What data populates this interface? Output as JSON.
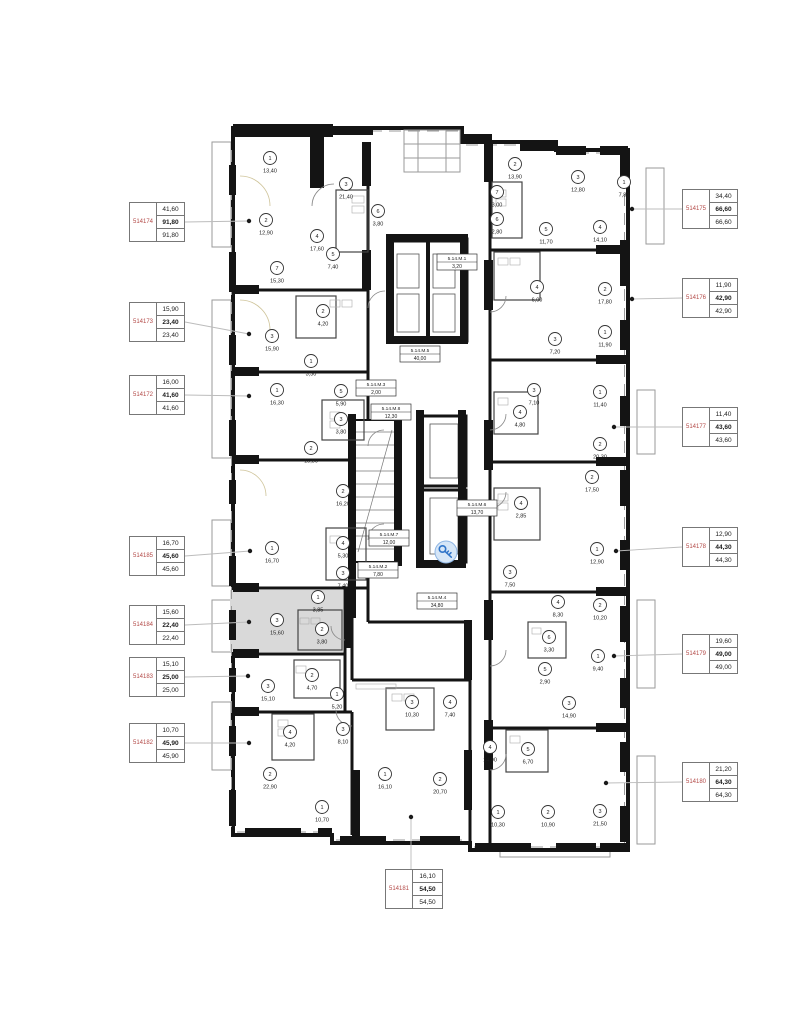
{
  "colors": {
    "wall": "#141414",
    "label_red": "#b34a48",
    "highlight_gray": "#d9d9d9",
    "marker_blue": "#2f74c9",
    "marker_fill": "#d6e6f7",
    "leader_gray": "#bcbcbc"
  },
  "apartment_labels": [
    {
      "id": "514174",
      "values": [
        "41,60",
        "91,80",
        "91,80"
      ],
      "side": "left",
      "box": {
        "x": 129,
        "y": 202,
        "w": 56,
        "h": 40
      },
      "dot": {
        "x": 249,
        "y": 221
      }
    },
    {
      "id": "514173",
      "values": [
        "15,90",
        "23,40",
        "23,40"
      ],
      "side": "left",
      "box": {
        "x": 129,
        "y": 302,
        "w": 56,
        "h": 40
      },
      "dot": {
        "x": 249,
        "y": 334
      }
    },
    {
      "id": "514172",
      "values": [
        "16,00",
        "41,60",
        "41,60"
      ],
      "side": "left",
      "box": {
        "x": 129,
        "y": 375,
        "w": 56,
        "h": 40
      },
      "dot": {
        "x": 249,
        "y": 396
      }
    },
    {
      "id": "514185",
      "values": [
        "16,70",
        "45,60",
        "45,60"
      ],
      "side": "left",
      "box": {
        "x": 129,
        "y": 536,
        "w": 56,
        "h": 40
      },
      "dot": {
        "x": 250,
        "y": 551
      }
    },
    {
      "id": "514184",
      "values": [
        "15,60",
        "22,40",
        "22,40"
      ],
      "side": "left",
      "box": {
        "x": 129,
        "y": 605,
        "w": 56,
        "h": 40
      },
      "dot": {
        "x": 249,
        "y": 622
      }
    },
    {
      "id": "514183",
      "values": [
        "15,10",
        "25,00",
        "25,00"
      ],
      "side": "left",
      "box": {
        "x": 129,
        "y": 657,
        "w": 56,
        "h": 40
      },
      "dot": {
        "x": 248,
        "y": 676
      }
    },
    {
      "id": "514182",
      "values": [
        "10,70",
        "45,90",
        "45,90"
      ],
      "side": "left",
      "box": {
        "x": 129,
        "y": 723,
        "w": 56,
        "h": 40
      },
      "dot": {
        "x": 249,
        "y": 743
      }
    },
    {
      "id": "514175",
      "values": [
        "34,40",
        "66,60",
        "66,60"
      ],
      "side": "right",
      "box": {
        "x": 682,
        "y": 189,
        "w": 56,
        "h": 40
      },
      "dot": {
        "x": 632,
        "y": 209
      }
    },
    {
      "id": "514176",
      "values": [
        "11,90",
        "42,90",
        "42,90"
      ],
      "side": "right",
      "box": {
        "x": 682,
        "y": 278,
        "w": 56,
        "h": 40
      },
      "dot": {
        "x": 632,
        "y": 299
      }
    },
    {
      "id": "514177",
      "values": [
        "11,40",
        "43,60",
        "43,60"
      ],
      "side": "right",
      "box": {
        "x": 682,
        "y": 407,
        "w": 56,
        "h": 40
      },
      "dot": {
        "x": 614,
        "y": 427
      }
    },
    {
      "id": "514178",
      "values": [
        "12,90",
        "44,30",
        "44,30"
      ],
      "side": "right",
      "box": {
        "x": 682,
        "y": 527,
        "w": 56,
        "h": 40
      },
      "dot": {
        "x": 616,
        "y": 551
      }
    },
    {
      "id": "514179",
      "values": [
        "19,60",
        "49,00",
        "49,00"
      ],
      "side": "right",
      "box": {
        "x": 682,
        "y": 634,
        "w": 56,
        "h": 40
      },
      "dot": {
        "x": 614,
        "y": 656
      }
    },
    {
      "id": "514180",
      "values": [
        "21,20",
        "64,30",
        "64,30"
      ],
      "side": "right",
      "box": {
        "x": 682,
        "y": 762,
        "w": 56,
        "h": 40
      },
      "dot": {
        "x": 606,
        "y": 783
      }
    },
    {
      "id": "514181",
      "values": [
        "16,10",
        "54,50",
        "54,50"
      ],
      "side": "bottom",
      "box": {
        "x": 385,
        "y": 869,
        "w": 58,
        "h": 40
      },
      "dot": {
        "x": 411,
        "y": 817
      }
    }
  ],
  "plan": {
    "selected_apartment": "514184",
    "marker": {
      "x": 446,
      "y": 552,
      "icon": "key"
    },
    "rooms": [
      {
        "apt": "514174",
        "num": "1",
        "area": "13,40",
        "x": 270,
        "y": 158
      },
      {
        "apt": "514174",
        "num": "3",
        "area": "21,40",
        "x": 346,
        "y": 184
      },
      {
        "apt": "514174",
        "num": "2",
        "area": "12,90",
        "x": 266,
        "y": 220
      },
      {
        "apt": "514174",
        "num": "4",
        "area": "17,60",
        "x": 317,
        "y": 236
      },
      {
        "apt": "514174",
        "num": "5",
        "area": "7,40",
        "x": 333,
        "y": 254
      },
      {
        "apt": "514174",
        "num": "6",
        "area": "3,80",
        "x": 378,
        "y": 211
      },
      {
        "apt": "514174",
        "num": "7",
        "area": "15,30",
        "x": 277,
        "y": 268
      },
      {
        "apt": "514173",
        "num": "2",
        "area": "4,20",
        "x": 323,
        "y": 311
      },
      {
        "apt": "514173",
        "num": "3",
        "area": "15,90",
        "x": 272,
        "y": 336
      },
      {
        "apt": "514173",
        "num": "1",
        "area": "3,30",
        "x": 311,
        "y": 361
      },
      {
        "apt": "514172",
        "num": "1",
        "area": "16,30",
        "x": 277,
        "y": 390
      },
      {
        "apt": "514172",
        "num": "5",
        "area": "5,90",
        "x": 341,
        "y": 391
      },
      {
        "apt": "514172",
        "num": "3",
        "area": "3,80",
        "x": 341,
        "y": 419
      },
      {
        "apt": "514172",
        "num": "2",
        "area": "15,80",
        "x": 311,
        "y": 448
      },
      {
        "apt": "514185",
        "num": "2",
        "area": "16,20",
        "x": 343,
        "y": 491
      },
      {
        "apt": "514185",
        "num": "4",
        "area": "5,30",
        "x": 343,
        "y": 543
      },
      {
        "apt": "514185",
        "num": "3",
        "area": "7,40",
        "x": 343,
        "y": 573
      },
      {
        "apt": "514185",
        "num": "1",
        "area": "16,70",
        "x": 272,
        "y": 548
      },
      {
        "apt": "514184",
        "num": "1",
        "area": "3,85",
        "x": 318,
        "y": 597
      },
      {
        "apt": "514184",
        "num": "3",
        "area": "15,60",
        "x": 277,
        "y": 620
      },
      {
        "apt": "514184",
        "num": "2",
        "area": "3,80",
        "x": 322,
        "y": 629
      },
      {
        "apt": "514183",
        "num": "2",
        "area": "4,70",
        "x": 312,
        "y": 675
      },
      {
        "apt": "514183",
        "num": "3",
        "area": "15,10",
        "x": 268,
        "y": 686
      },
      {
        "apt": "514183",
        "num": "1",
        "area": "5,20",
        "x": 337,
        "y": 694
      },
      {
        "apt": "514182",
        "num": "4",
        "area": "4,20",
        "x": 290,
        "y": 732
      },
      {
        "apt": "514182",
        "num": "3",
        "area": "8,10",
        "x": 343,
        "y": 729
      },
      {
        "apt": "514182",
        "num": "2",
        "area": "22,90",
        "x": 270,
        "y": 774
      },
      {
        "apt": "514182",
        "num": "1",
        "area": "10,70",
        "x": 322,
        "y": 807
      },
      {
        "apt": "514181",
        "num": "3",
        "area": "10,30",
        "x": 412,
        "y": 702
      },
      {
        "apt": "514181",
        "num": "4",
        "area": "7,40",
        "x": 450,
        "y": 702
      },
      {
        "apt": "514181",
        "num": "1",
        "area": "16,10",
        "x": 385,
        "y": 774
      },
      {
        "apt": "514181",
        "num": "2",
        "area": "20,70",
        "x": 440,
        "y": 779
      },
      {
        "apt": "514175",
        "num": "2",
        "area": "13,90",
        "x": 515,
        "y": 164
      },
      {
        "apt": "514175",
        "num": "3",
        "area": "12,80",
        "x": 578,
        "y": 177
      },
      {
        "apt": "514175",
        "num": "1",
        "area": "7,80",
        "x": 624,
        "y": 182
      },
      {
        "apt": "514175",
        "num": "7",
        "area": "3,00",
        "x": 497,
        "y": 192
      },
      {
        "apt": "514175",
        "num": "6",
        "area": "2,80",
        "x": 497,
        "y": 219
      },
      {
        "apt": "514175",
        "num": "5",
        "area": "11,70",
        "x": 546,
        "y": 229
      },
      {
        "apt": "514175",
        "num": "4",
        "area": "14,10",
        "x": 600,
        "y": 227
      },
      {
        "apt": "514176",
        "num": "4",
        "area": "6,00",
        "x": 537,
        "y": 287
      },
      {
        "apt": "514176",
        "num": "2",
        "area": "17,80",
        "x": 605,
        "y": 289
      },
      {
        "apt": "514176",
        "num": "3",
        "area": "7,20",
        "x": 555,
        "y": 339
      },
      {
        "apt": "514176",
        "num": "1",
        "area": "11,90",
        "x": 605,
        "y": 332
      },
      {
        "apt": "514177",
        "num": "3",
        "area": "7,10",
        "x": 534,
        "y": 390
      },
      {
        "apt": "514177",
        "num": "1",
        "area": "11,40",
        "x": 600,
        "y": 392
      },
      {
        "apt": "514177",
        "num": "4",
        "area": "4,80",
        "x": 520,
        "y": 412
      },
      {
        "apt": "514177",
        "num": "2",
        "area": "20,30",
        "x": 600,
        "y": 444
      },
      {
        "apt": "514178",
        "num": "2",
        "area": "17,50",
        "x": 592,
        "y": 477
      },
      {
        "apt": "514178",
        "num": "4",
        "area": "2,85",
        "x": 521,
        "y": 503
      },
      {
        "apt": "514178",
        "num": "1",
        "area": "12,90",
        "x": 597,
        "y": 549
      },
      {
        "apt": "514178",
        "num": "3",
        "area": "7,50",
        "x": 510,
        "y": 572
      },
      {
        "apt": "514179",
        "num": "4",
        "area": "8,30",
        "x": 558,
        "y": 602
      },
      {
        "apt": "514179",
        "num": "2",
        "area": "10,20",
        "x": 600,
        "y": 605
      },
      {
        "apt": "514179",
        "num": "6",
        "area": "3,30",
        "x": 549,
        "y": 637
      },
      {
        "apt": "514179",
        "num": "1",
        "area": "9,40",
        "x": 598,
        "y": 656
      },
      {
        "apt": "514179",
        "num": "5",
        "area": "2,90",
        "x": 545,
        "y": 669
      },
      {
        "apt": "514179",
        "num": "3",
        "area": "14,90",
        "x": 569,
        "y": 703
      },
      {
        "apt": "514180",
        "num": "4",
        "area": "14,90",
        "x": 490,
        "y": 747
      },
      {
        "apt": "514180",
        "num": "5",
        "area": "6,70",
        "x": 528,
        "y": 749
      },
      {
        "apt": "514180",
        "num": "1",
        "area": "10,30",
        "x": 498,
        "y": 812
      },
      {
        "apt": "514180",
        "num": "2",
        "area": "10,90",
        "x": 548,
        "y": 812
      },
      {
        "apt": "514180",
        "num": "3",
        "area": "21,50",
        "x": 600,
        "y": 811
      }
    ],
    "core_rooms": [
      {
        "name": "5.14.M.1",
        "area": "3,20",
        "x": 457,
        "y": 262
      },
      {
        "name": "5.14.M.5",
        "area": "40,00",
        "x": 420,
        "y": 354
      },
      {
        "name": "5.14.M.3",
        "area": "2,00",
        "x": 376,
        "y": 388
      },
      {
        "name": "5.14.M.8",
        "area": "12,30",
        "x": 391,
        "y": 412
      },
      {
        "name": "5.14.M.6",
        "area": "13,70",
        "x": 477,
        "y": 508
      },
      {
        "name": "5.14.M.7",
        "area": "12,00",
        "x": 389,
        "y": 538
      },
      {
        "name": "5.14.M.2",
        "area": "7,80",
        "x": 378,
        "y": 570
      },
      {
        "name": "5.14.M.4",
        "area": "34,80",
        "x": 437,
        "y": 601
      }
    ]
  }
}
